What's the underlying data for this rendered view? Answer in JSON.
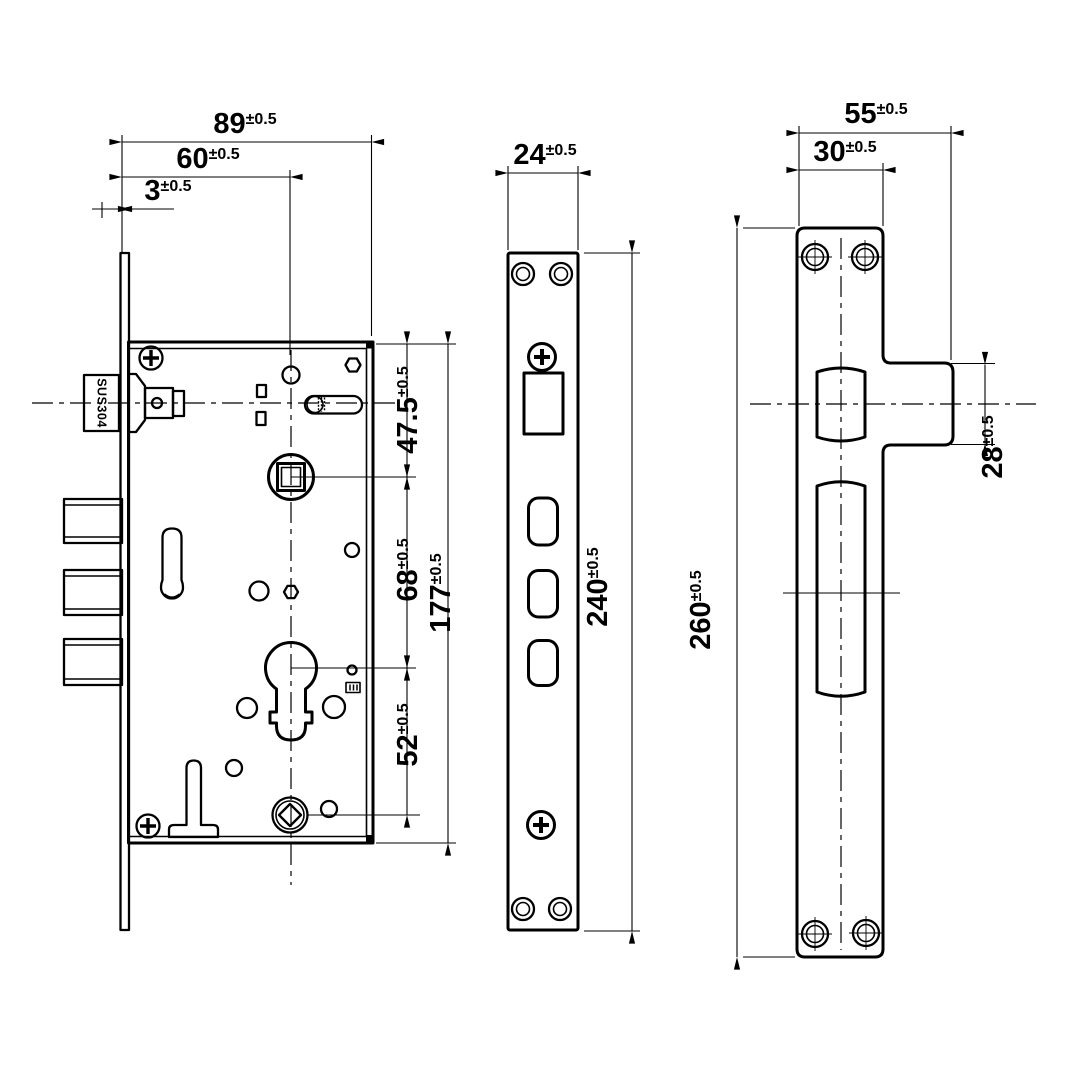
{
  "drawing": {
    "material_label": "SUS304",
    "dimensions": {
      "d89": {
        "v": "89",
        "t": "±0.5"
      },
      "d60": {
        "v": "60",
        "t": "±0.5"
      },
      "d3": {
        "v": "3",
        "t": "±0.5"
      },
      "d475": {
        "v": "47.5",
        "t": "±0.5"
      },
      "d68": {
        "v": "68",
        "t": "±0.5"
      },
      "d52": {
        "v": "52",
        "t": "±0.5"
      },
      "d177": {
        "v": "177",
        "t": "±0.5"
      },
      "d24": {
        "v": "24",
        "t": "±0.5"
      },
      "d240": {
        "v": "240",
        "t": "±0.5"
      },
      "d55": {
        "v": "55",
        "t": "±0.5"
      },
      "d30": {
        "v": "30",
        "t": "±0.5"
      },
      "d28": {
        "v": "28",
        "t": "±0.5"
      },
      "d260": {
        "v": "260",
        "t": "±0.5"
      }
    }
  }
}
